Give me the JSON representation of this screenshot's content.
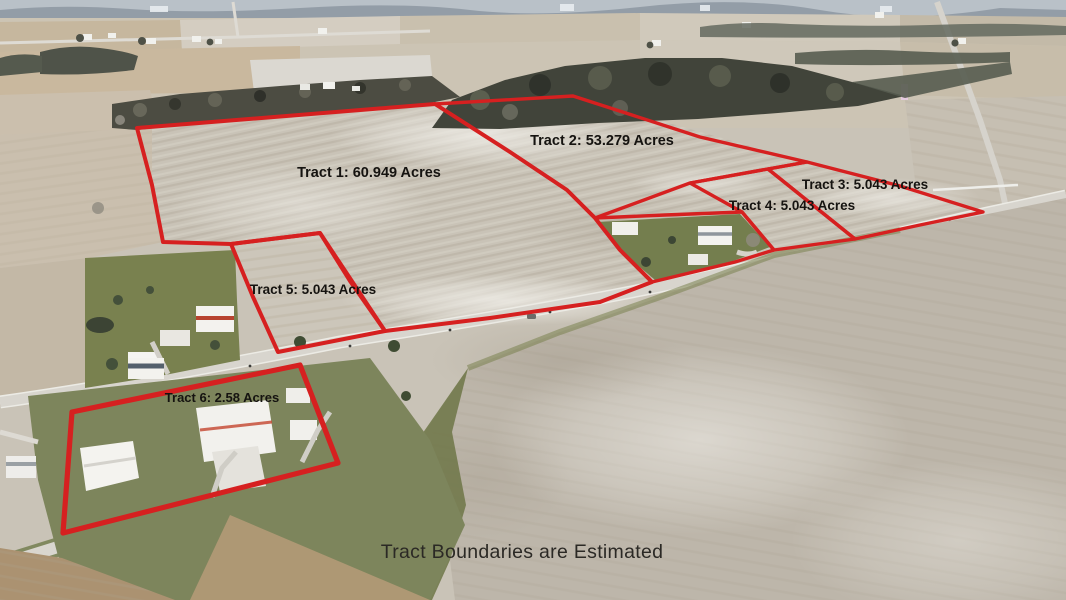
{
  "caption": "Tract Boundaries are Estimated",
  "colors": {
    "boundary": "#d62020",
    "label_text": "#151310",
    "caption_text": "#2b2925"
  },
  "tracts": [
    {
      "name": "Tract 1",
      "acres": "60.949",
      "label": "Tract 1: 60.949 Acres",
      "polygon": "137,128 435,104 510,152 567,190 595,218 620,250 652,282 600,302 490,318 385,331 320,233 231,244 163,242 152,185"
    },
    {
      "name": "Tract 2",
      "acres": "53.279",
      "label": "Tract 2: 53.279 Acres",
      "polygon": "435,104 573,96 700,137 807,162 690,183 595,218 567,190 510,152"
    },
    {
      "name": "Tract 3",
      "acres": "5.043",
      "label": "Tract 3: 5.043 Acres",
      "polygon": "807,162 900,186 983,212 920,225 855,239 768,169"
    },
    {
      "name": "Tract 4",
      "acres": "5.043",
      "label": "Tract 4: 5.043 Acres",
      "polygon": "690,183 768,169 855,239 774,250 742,212"
    },
    {
      "name": "Tract 5",
      "acres": "5.043",
      "label": "Tract 5: 5.043 Acres",
      "polygon": "231,244 320,233 350,281 385,331 278,352 253,297"
    },
    {
      "name": "Tract 6",
      "acres": "2.58",
      "label": "Tract 6: 2.58 Acres",
      "polygon": "300,365 72,412 63,533 338,463"
    }
  ],
  "excluded_lot_polygon": "595,218 665,215 742,212 774,250 735,262 652,282 620,250"
}
